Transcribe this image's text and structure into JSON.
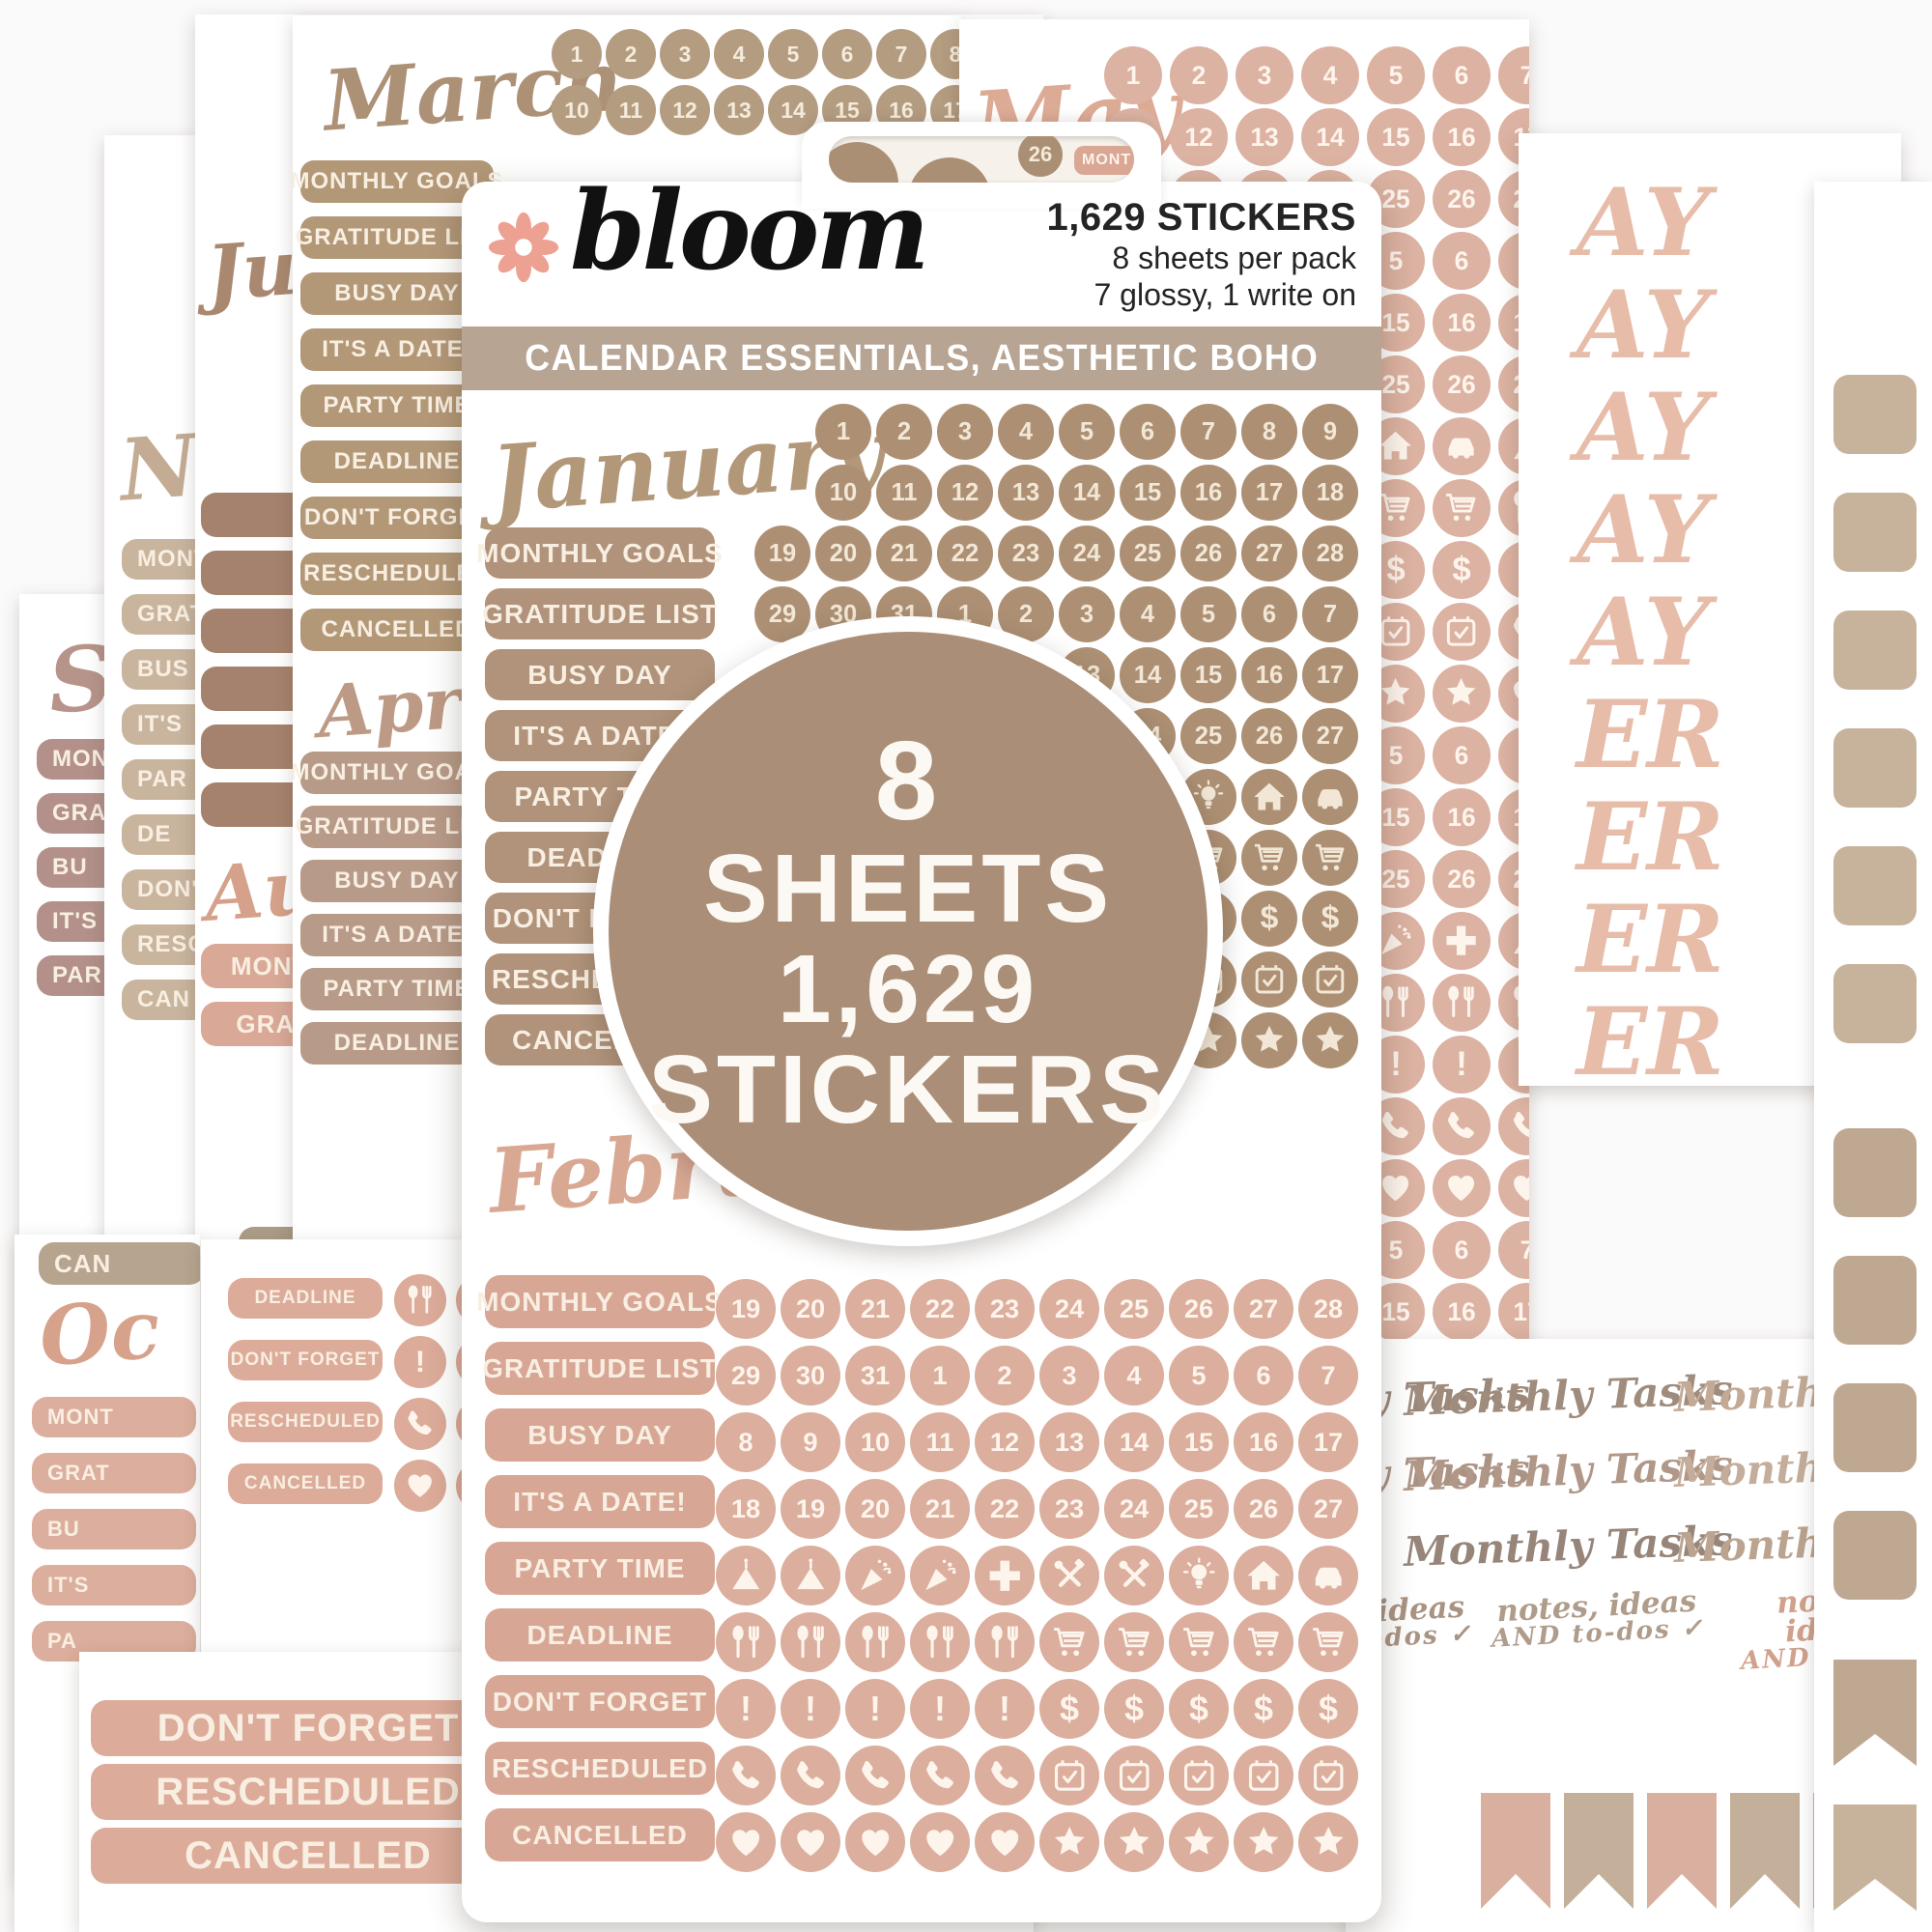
{
  "brand": {
    "name": "bloom"
  },
  "pack": {
    "sticker_count_line": "1,629 STICKERS",
    "sheets_line": "8 sheets per pack",
    "finish_line": "7 glossy, 1 write on",
    "banner": "CALENDAR ESSENTIALS, AESTHETIC BOHO",
    "badge_lines": [
      "8",
      "SHEETS",
      "1,629",
      "STICKERS"
    ],
    "tab_number": "26",
    "tab_pill": "MONT"
  },
  "months": {
    "january": "January",
    "february": "February",
    "march": "March",
    "april": "April",
    "may": "May",
    "september_frag": "Sep",
    "november_frag": "No",
    "july_frag": "Ju",
    "august_frag": "Au",
    "october_frag": "Oc",
    "cancelled_frag": "CAN"
  },
  "labels_full": [
    "MONTHLY GOALS",
    "GRATITUDE LIST",
    "BUSY DAY",
    "IT'S A DATE!",
    "PARTY TIME",
    "DEADLINE",
    "DON'T FORGET",
    "RESCHEDULED",
    "CANCELLED"
  ],
  "grids": {
    "march_rows": [
      [
        1,
        2,
        3,
        4,
        5,
        6,
        7,
        8,
        9
      ],
      [
        10,
        11,
        12,
        13,
        14,
        15,
        16,
        17,
        18
      ]
    ],
    "january_rows": [
      [
        1,
        2,
        3,
        4,
        5,
        6,
        7,
        8,
        9
      ],
      [
        10,
        11,
        12,
        13,
        14,
        15,
        16,
        17,
        18
      ],
      [
        19,
        20,
        21,
        22,
        23,
        24,
        25,
        26,
        27,
        28
      ],
      [
        29,
        30,
        31,
        1,
        2,
        3,
        4,
        5,
        6,
        7
      ],
      [
        8,
        9,
        10,
        11,
        12,
        13,
        14,
        15,
        16,
        17
      ],
      [
        18,
        19,
        20,
        21,
        22,
        23,
        24,
        25,
        26,
        27
      ],
      [
        "cake",
        "cake",
        "party",
        "party",
        "plus",
        "tools",
        "tools",
        "bulb",
        "house",
        "car"
      ],
      [
        "utensils",
        "utensils",
        "utensils",
        "utensils",
        "utensils",
        "cart",
        "cart",
        "cart",
        "cart",
        "cart"
      ],
      [
        "exclaim",
        "exclaim",
        "exclaim",
        "exclaim",
        "exclaim",
        "dollar",
        "dollar",
        "dollar",
        "dollar",
        "dollar"
      ],
      [
        "phone",
        "phone",
        "phone",
        "phone",
        "phone",
        "calendar",
        "calendar",
        "calendar",
        "calendar",
        "calendar"
      ],
      [
        "heart",
        "heart",
        "heart",
        "heart",
        "heart",
        "star",
        "star",
        "star",
        "star",
        "star"
      ]
    ],
    "february_rows": [
      [
        19,
        20,
        21,
        22,
        23,
        24,
        25,
        26,
        27,
        28
      ],
      [
        29,
        30,
        31,
        1,
        2,
        3,
        4,
        5,
        6,
        7
      ],
      [
        8,
        9,
        10,
        11,
        12,
        13,
        14,
        15,
        16,
        17
      ],
      [
        18,
        19,
        20,
        21,
        22,
        23,
        24,
        25,
        26,
        27
      ],
      [
        "cake",
        "cake",
        "party",
        "party",
        "plus",
        "tools",
        "tools",
        "bulb",
        "house",
        "car"
      ],
      [
        "utensils",
        "utensils",
        "utensils",
        "utensils",
        "utensils",
        "cart",
        "cart",
        "cart",
        "cart",
        "cart"
      ],
      [
        "exclaim",
        "exclaim",
        "exclaim",
        "exclaim",
        "exclaim",
        "dollar",
        "dollar",
        "dollar",
        "dollar",
        "dollar"
      ],
      [
        "phone",
        "phone",
        "phone",
        "phone",
        "phone",
        "calendar",
        "calendar",
        "calendar",
        "calendar",
        "calendar"
      ],
      [
        "heart",
        "heart",
        "heart",
        "heart",
        "heart",
        "star",
        "star",
        "star",
        "star",
        "star"
      ]
    ],
    "may_rows": [
      [
        1,
        2,
        3,
        4,
        5,
        6,
        7,
        8,
        9,
        10
      ],
      [
        11,
        12,
        13,
        14,
        15,
        16,
        17,
        18,
        19,
        20
      ],
      [
        21,
        22,
        23,
        24,
        25,
        26,
        27,
        28,
        29,
        30
      ],
      [
        1,
        2,
        3,
        4,
        5,
        6,
        7,
        8,
        9,
        10
      ],
      [
        11,
        12,
        13,
        14,
        15,
        16,
        17,
        18,
        19,
        20
      ],
      [
        21,
        22,
        23,
        24,
        25,
        26,
        27,
        28,
        29,
        30
      ],
      [
        "party",
        "plus",
        "tools",
        "bulb",
        "house",
        "car",
        "cake",
        "cake",
        "party",
        "plus"
      ],
      [
        "utensils",
        "cart",
        "cart",
        "cart",
        "cart",
        "cart",
        "utensils",
        "utensils",
        "utensils",
        "utensils"
      ],
      [
        "exclaim",
        "dollar",
        "dollar",
        "dollar",
        "dollar",
        "dollar",
        "exclaim",
        "exclaim",
        "exclaim",
        "exclaim"
      ],
      [
        "phone",
        "calendar",
        "calendar",
        "calendar",
        "calendar",
        "calendar",
        "phone",
        "phone",
        "phone",
        "phone"
      ],
      [
        "heart",
        "star",
        "star",
        "star",
        "star",
        "star",
        "heart",
        "heart",
        "heart",
        "heart"
      ],
      [
        1,
        2,
        3,
        4,
        5,
        6,
        7,
        8,
        9,
        10
      ],
      [
        11,
        12,
        13,
        14,
        15,
        16,
        17,
        18,
        19,
        20
      ],
      [
        21,
        22,
        23,
        24,
        25,
        26,
        27,
        28,
        29,
        30
      ],
      [
        "tools",
        "bulb",
        "house",
        "car",
        "party",
        "plus",
        "cake",
        "cake",
        "party",
        "plus"
      ],
      [
        "cart",
        "cart",
        "cart",
        "cart",
        "utensils",
        "utensils",
        "utensils",
        "utensils",
        "utensils",
        "utensils"
      ],
      [
        "dollar",
        "dollar",
        "dollar",
        "dollar",
        "exclaim",
        "exclaim",
        "exclaim",
        "exclaim",
        "exclaim",
        "exclaim"
      ],
      [
        "calendar",
        "calendar",
        "calendar",
        "calendar",
        "phone",
        "phone",
        "phone",
        "phone",
        "phone",
        "phone"
      ],
      [
        "star",
        "star",
        "star",
        "star",
        "heart",
        "heart",
        "heart",
        "heart",
        "heart",
        "heart"
      ],
      [
        1,
        2,
        3,
        4,
        5,
        6,
        7,
        8,
        9,
        10
      ],
      [
        11,
        12,
        13,
        14,
        15,
        16,
        17,
        18,
        19,
        20
      ]
    ]
  },
  "sheets": {
    "september": {
      "pills": [
        "MONT",
        "GRAT",
        "BU",
        "IT'S",
        "PAR"
      ]
    },
    "november": {
      "pills": [
        "MONT",
        "GRAT",
        "BUS",
        "IT'S",
        "PAR",
        "DE",
        "DON'",
        "RESC",
        "CAN"
      ],
      "pills2": [
        "GRAT",
        "BU",
        "IT'S",
        "PA"
      ]
    },
    "july": {
      "brown_pills": [
        "IT'S A",
        "PARTY",
        "DEADL",
        "DON'T",
        "RESCH",
        "CANC"
      ],
      "pink_pills": [
        "MONTHLY GOALS",
        "GRATITUDE LIST"
      ],
      "bottom_pills": [
        "DEADLINE",
        "DON'T FORGET",
        "RESCHEDULED",
        "CANCELLED"
      ],
      "bottom_icon_rows": [
        [
          "exclaim",
          "exclaim",
          "exclaim"
        ],
        [
          "phone",
          "phone",
          "phone"
        ],
        [
          "heart",
          "heart",
          "heart"
        ]
      ]
    },
    "marapr": {
      "april_labels": [
        "MONTHLY GOALS",
        "GRATITUDE LIST",
        "BUSY DAY",
        "IT'S A DATE!",
        "PARTY TIME",
        "DEADLINE"
      ]
    },
    "october_left": {
      "pills": [
        "MONT",
        "GRAT",
        "BU",
        "IT'S",
        "PA"
      ]
    },
    "october_mini": {
      "pills": [
        "DEADLINE",
        "DON'T FORGET",
        "RESCHEDULED",
        "CANCELLED"
      ],
      "icon_rows": [
        [
          "utensils",
          "utensils"
        ],
        [
          "exclaim",
          "exclaim"
        ],
        [
          "phone",
          "phone"
        ],
        [
          "heart",
          "heart"
        ]
      ]
    },
    "bottom_pink": {
      "pills": [
        "DON'T FORGET",
        "RESCHEDULED",
        "CANCELLED"
      ],
      "icon_rows": [
        [
          "exclaim",
          "exclaim",
          "exclaim",
          "exclaim"
        ],
        [
          "phone",
          "phone",
          "phone",
          "phone"
        ],
        [
          "heart",
          "heart",
          "heart",
          "heart"
        ]
      ]
    }
  },
  "ay_fragments": [
    "AY",
    "AY",
    "AY",
    "AY",
    "AY",
    "ER",
    "ER",
    "ER",
    "ER"
  ],
  "tasks": {
    "item": "Monthly Tasks",
    "notes_top": "notes, ideas",
    "notes_bottom": "AND  to-dos ✓"
  }
}
